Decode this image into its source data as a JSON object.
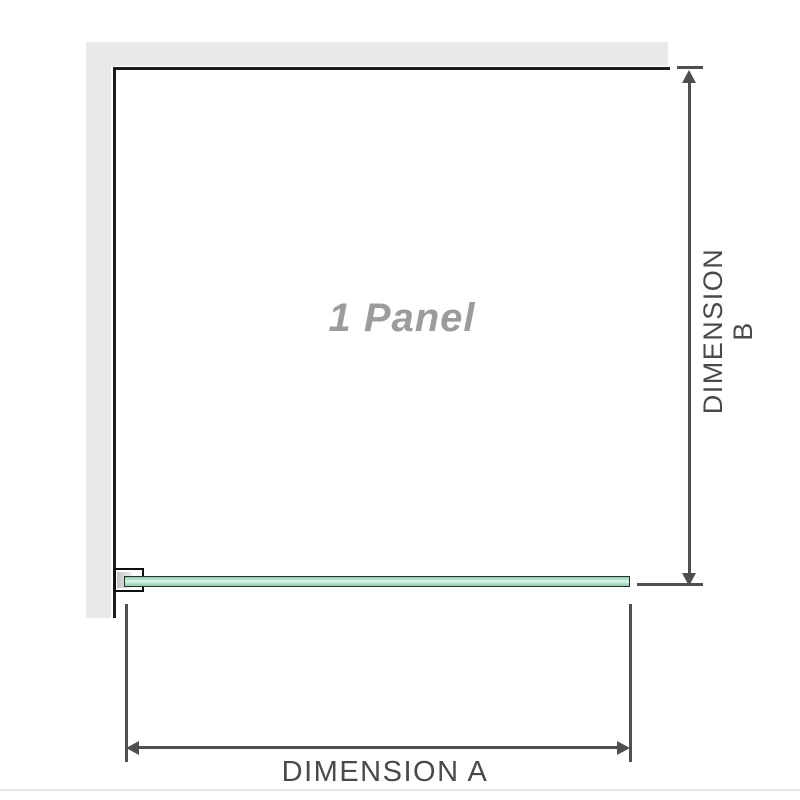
{
  "diagram": {
    "title": "Shower panel dimension diagram",
    "panel_label": "1 Panel",
    "dimension_a_label": "DIMENSION A",
    "dimension_b_label": "DIMENSION B"
  },
  "colors": {
    "wall_gray": "#e9e9e9",
    "panel_outline": "#1d1d1d",
    "dimension_lines": "#4f4f4f",
    "dimension_text": "#4a4a4a",
    "panel_label_gray": "#9c9c9c",
    "glass_green": "#a9dcc3",
    "glass_highlight": "#e0f4ea",
    "glass_border": "#25332b",
    "bracket_border": "#0f0f0f",
    "bottom_rule": "#e9e6e0"
  }
}
